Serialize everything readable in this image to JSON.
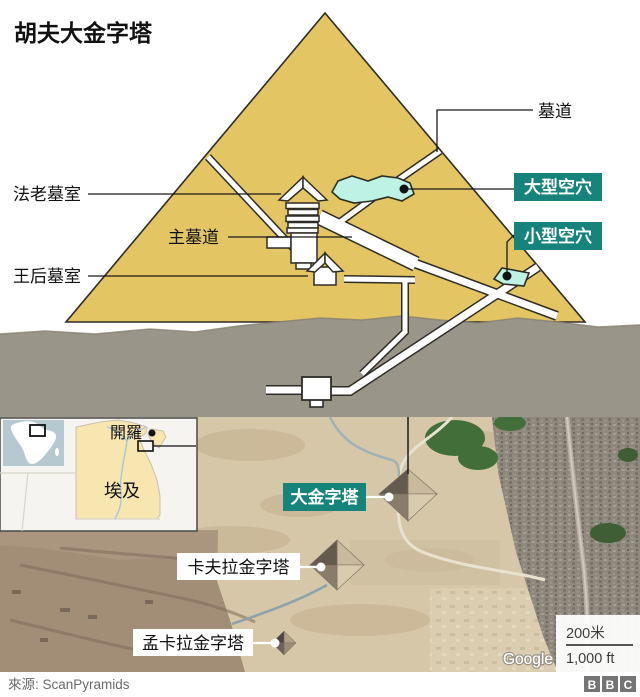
{
  "title": "胡夫大金字塔",
  "colors": {
    "pyramid_fill": "#e3c663",
    "ground_fill": "#9a9589",
    "void_fill": "#bdf2e5",
    "teal_label": "#16847b",
    "outline": "#2e2c26"
  },
  "diagram": {
    "labels": {
      "corridor": "墓道",
      "kings_chamber": "法老墓室",
      "grand_gallery": "主墓道",
      "queens_chamber": "王后墓室",
      "big_void": "大型空穴",
      "small_void": "小型空穴"
    }
  },
  "map": {
    "labels": {
      "great_pyramid": "大金字塔",
      "khafre": "卡夫拉金字塔",
      "menkaure": "孟卡拉金字塔"
    },
    "inset": {
      "cairo": "開羅",
      "egypt": "埃及"
    },
    "scale": {
      "metric": "200米",
      "imperial": "1,000 ft"
    },
    "credit": "Google"
  },
  "footer": {
    "source": "來源: ScanPyramids",
    "logo": [
      "B",
      "B",
      "C"
    ]
  }
}
